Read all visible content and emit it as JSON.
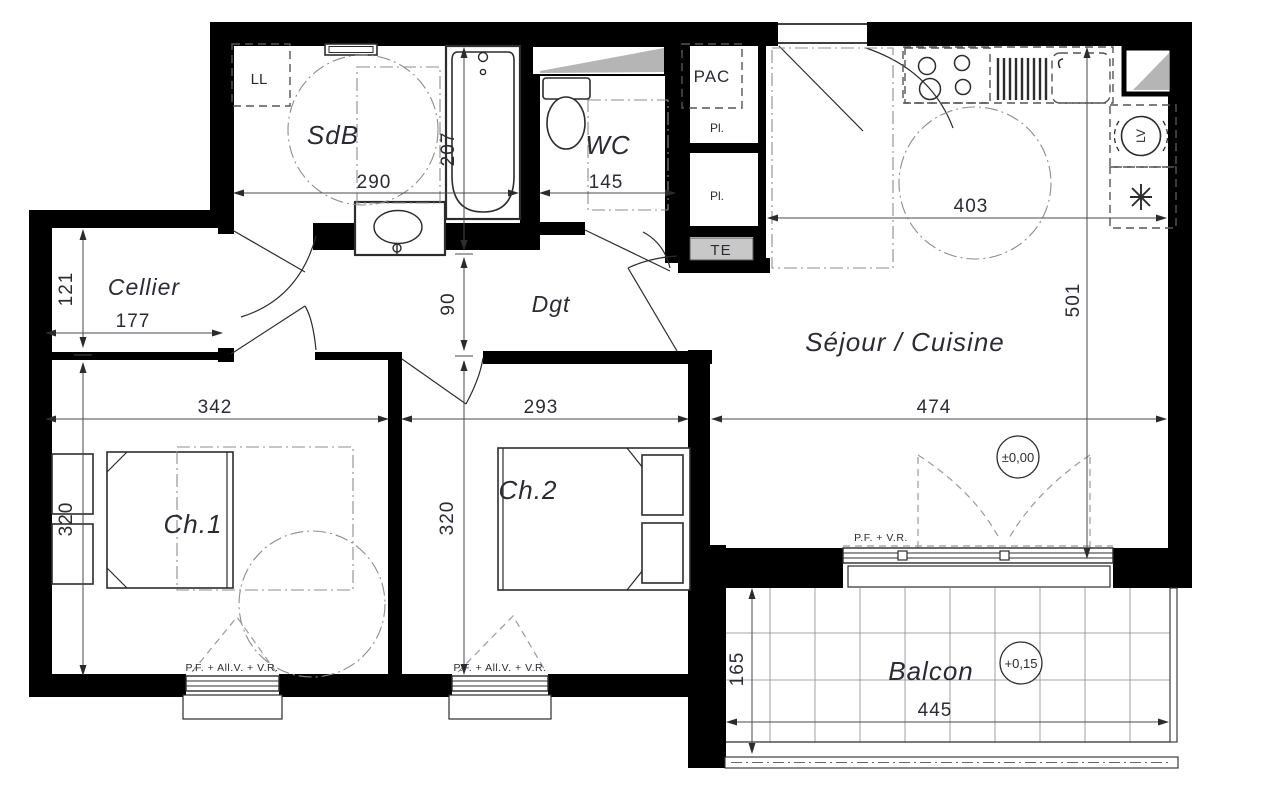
{
  "plan": {
    "rooms": {
      "sdb": "SdB",
      "wc": "WC",
      "cellier": "Cellier",
      "dgt": "Dgt",
      "sejour": "Séjour / Cuisine",
      "ch1": "Ch.1",
      "ch2": "Ch.2",
      "balcon": "Balcon"
    },
    "features": {
      "ll": "LL",
      "pac": "PAC",
      "pl_top": "Pl.",
      "pl_bottom": "Pl.",
      "te": "TE",
      "lv": "LV"
    },
    "dimensions": {
      "sdb_width": "290",
      "bath_depth": "207",
      "wc_width": "145",
      "cuisine_width": "403",
      "sejour_depth": "501",
      "cellier_depth": "121",
      "cellier_width": "177",
      "dgt_depth": "90",
      "ch1_width": "342",
      "ch2_width": "293",
      "sejour_width": "474",
      "ch1_depth": "320",
      "ch2_depth": "320",
      "balcon_depth": "165",
      "balcon_width": "445"
    },
    "levels": {
      "sejour": "±0,00",
      "balcon": "+0,15"
    },
    "window_tags": {
      "sejour": "P.F. + V.R.",
      "ch1": "P.F. + All.V. + V.R.",
      "ch2": "P.F. + All.V. + V.R."
    }
  }
}
